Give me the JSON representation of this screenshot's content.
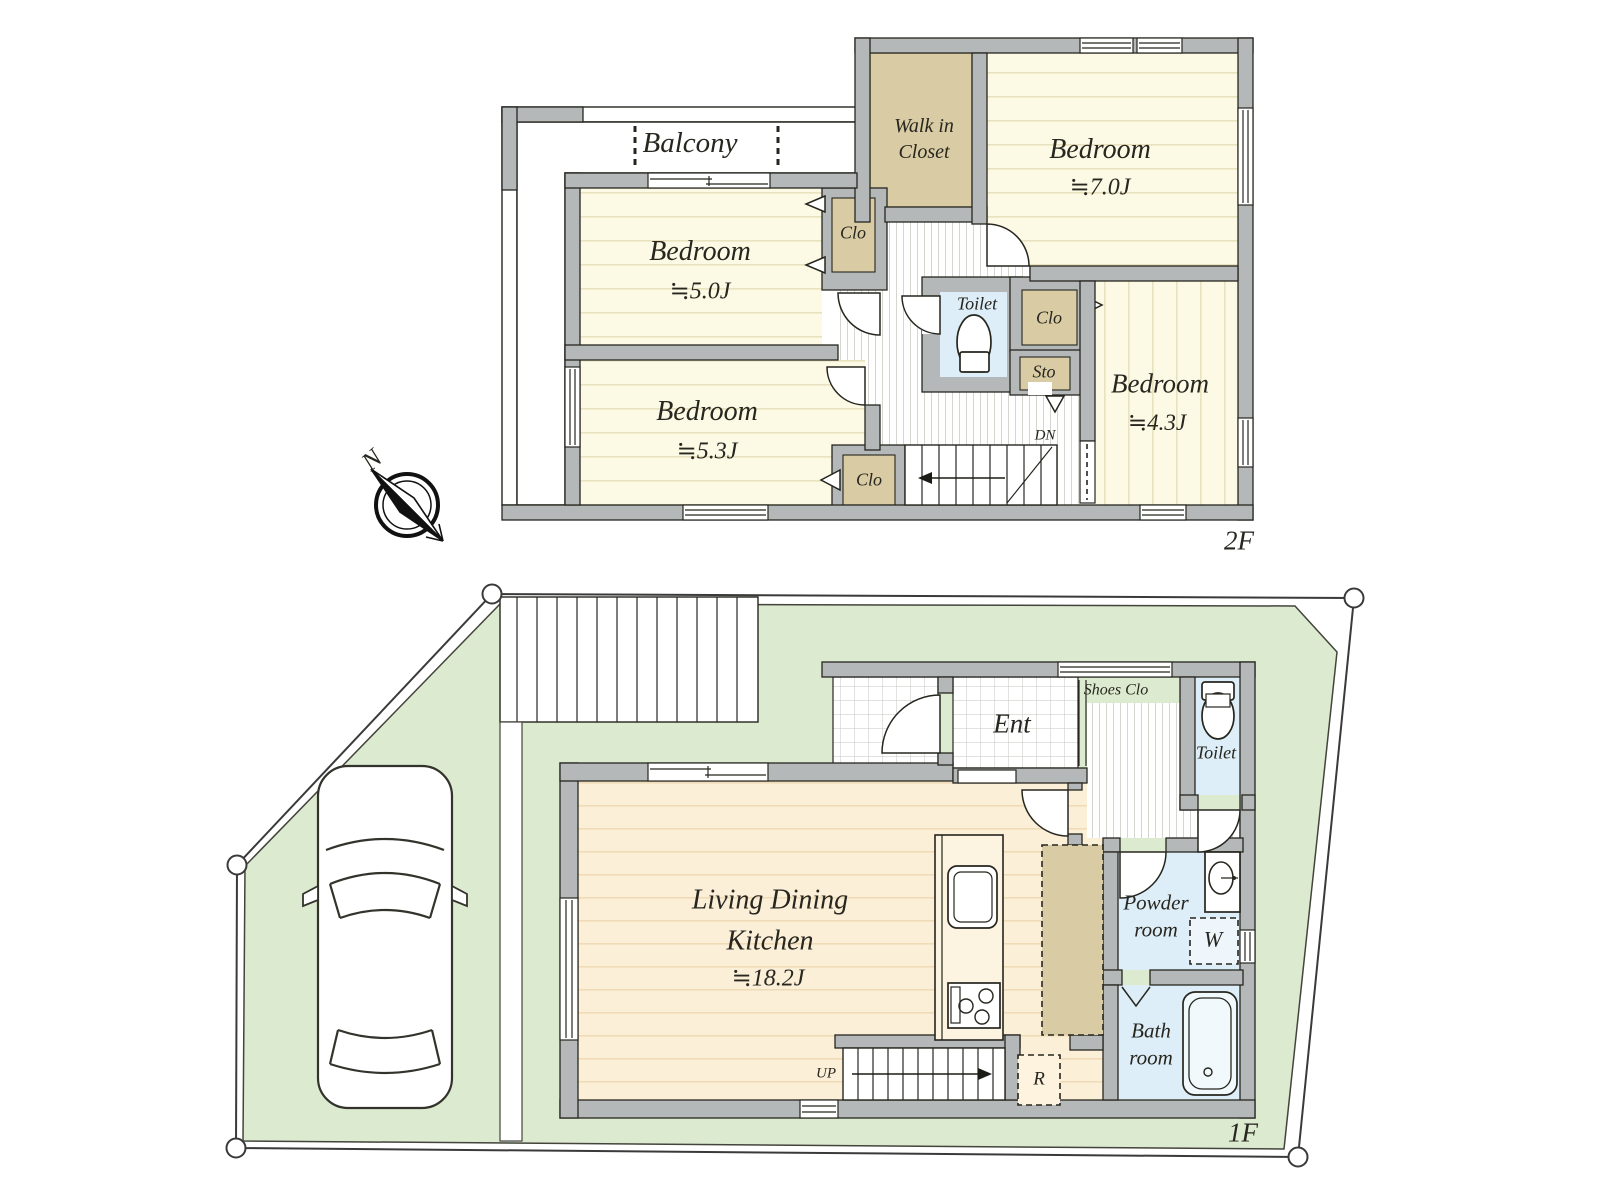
{
  "title": "House floor plan",
  "colors": {
    "wall_gray": "#b5b8b9",
    "room_cream": "#fcf9e5",
    "closet_tan": "#d9cba3",
    "wet_area_blue": "#deeef8",
    "ldk_peach": "#fcefd8",
    "site_green": "#dcead0"
  },
  "floor2": {
    "floor_label": "2F",
    "balcony_label": "Balcony",
    "walk_in_closet_label": "Walk in Closet",
    "bedroom_north": {
      "name": "Bedroom",
      "size": "≒7.0J"
    },
    "bedroom_west": {
      "name": "Bedroom",
      "size": "≒5.0J"
    },
    "bedroom_southwest": {
      "name": "Bedroom",
      "size": "≒5.3J"
    },
    "bedroom_east": {
      "name": "Bedroom",
      "size": "≒4.3J"
    },
    "toilet_label": "Toilet",
    "closet_west_label": "Clo",
    "closet_southwest_label": "Clo",
    "closet_east_label": "Clo",
    "storage_label": "Sto",
    "stairs_down_label": "DN"
  },
  "floor1": {
    "floor_label": "1F",
    "entrance_label": "Ent",
    "shoes_closet_label": "Shoes Clo",
    "toilet_label": "Toilet",
    "ldk": {
      "name": "Living Dining Kitchen",
      "size": "≒18.2J"
    },
    "stairs_up_label": "UP",
    "refrigerator_label": "R",
    "powder_room_label": "Powder room",
    "washer_label": "W",
    "bath_room_label": "Bath room"
  },
  "compass_label": "N"
}
